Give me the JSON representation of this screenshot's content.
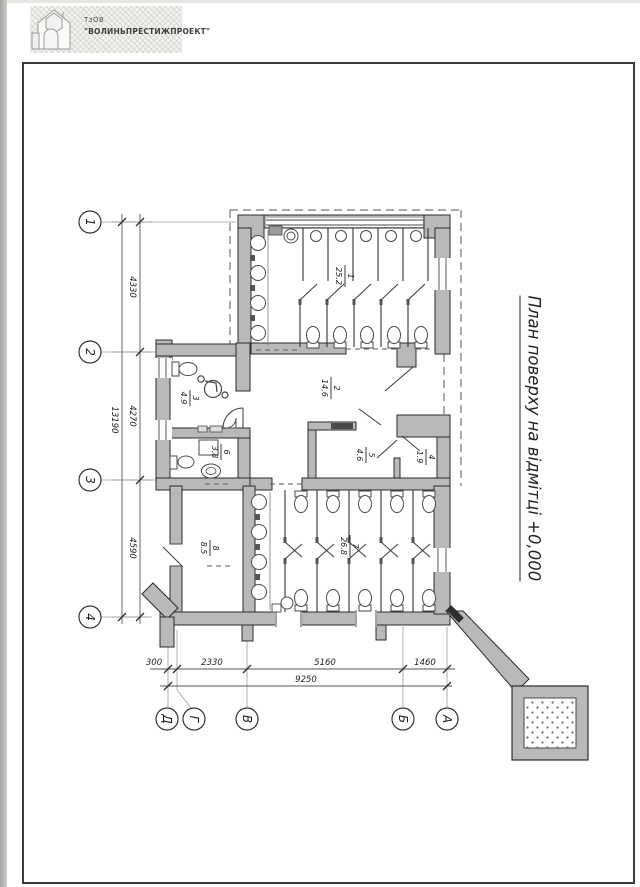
{
  "page": {
    "logo": {
      "company_type": "ТзОВ",
      "company_name": "\"ВОЛИНЬПРЕСТИЖПРОЕКТ\""
    },
    "title": "План поверху на відмітці +0,000"
  },
  "axes": {
    "rows": [
      {
        "label": "1"
      },
      {
        "label": "2"
      },
      {
        "label": "3"
      },
      {
        "label": "4"
      }
    ],
    "cols": [
      {
        "label": "Д"
      },
      {
        "label": "Г"
      },
      {
        "label": "В"
      },
      {
        "label": "Б"
      },
      {
        "label": "А"
      }
    ]
  },
  "dimensions": {
    "left_segments": [
      "4330",
      "4270",
      "4590"
    ],
    "left_total": "13190",
    "bottom_segments": [
      "300",
      "2330",
      "5160",
      "1460"
    ],
    "bottom_total": "9250"
  },
  "rooms": [
    {
      "number": "1",
      "area": "25.2"
    },
    {
      "number": "2",
      "area": "14.6"
    },
    {
      "number": "3",
      "area": "4.9"
    },
    {
      "number": "4",
      "area": "1.9"
    },
    {
      "number": "5",
      "area": "4.6"
    },
    {
      "number": "6",
      "area": "3.8"
    },
    {
      "number": "7",
      "area": "26.8"
    },
    {
      "number": "8",
      "area": "8.5"
    }
  ],
  "colors": {
    "wall_fill": "#b9b9b9",
    "line": "#2e2e2e",
    "frame": "#3a3a3a"
  }
}
